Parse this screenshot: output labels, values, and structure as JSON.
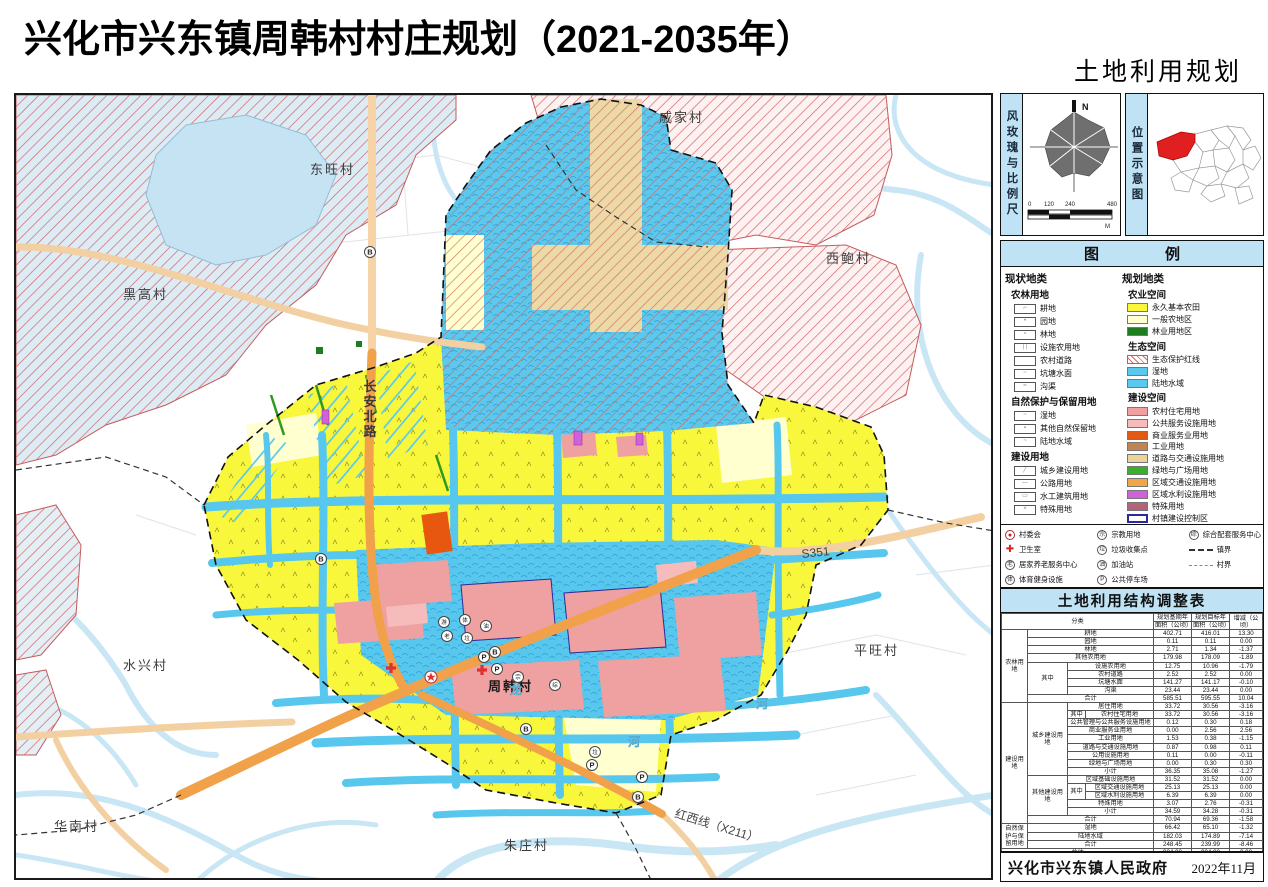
{
  "page": {
    "title": "兴化市兴东镇周韩村村庄规划（2021-2035年）",
    "map_title": "土地利用规划图"
  },
  "compass_panel": {
    "label": "风玫瑰与比例尺",
    "north_label": "N",
    "scale_ticks": [
      "0",
      "120",
      "240",
      "480"
    ],
    "scale_unit": "M"
  },
  "location_panel": {
    "label": "位置示意图"
  },
  "legend": {
    "title_left": "图",
    "title_right": "例",
    "current": {
      "title": "现状地类",
      "groups": [
        {
          "title": "农林用地",
          "items": [
            {
              "label": "耕地",
              "mark": "⌐"
            },
            {
              "label": "园地",
              "mark": "•"
            },
            {
              "label": "林地",
              "mark": "∘"
            },
            {
              "label": "设施农用地",
              "mark": "| |"
            },
            {
              "label": "农村道路",
              "mark": ""
            },
            {
              "label": "坑塘水面",
              "mark": "~"
            },
            {
              "label": "沟渠",
              "mark": "≈"
            }
          ]
        },
        {
          "title": "自然保护与保留用地",
          "items": [
            {
              "label": "湿地",
              "mark": "~"
            },
            {
              "label": "其他自然保留地",
              "mark": "▪"
            },
            {
              "label": "陆地水域",
              "mark": "~"
            }
          ]
        },
        {
          "title": "建设用地",
          "items": [
            {
              "label": "城乡建设用地",
              "mark": "╱"
            },
            {
              "label": "公路用地",
              "mark": "—"
            },
            {
              "label": "水工建筑用地",
              "mark": "▭"
            },
            {
              "label": "特殊用地",
              "mark": "×"
            }
          ]
        }
      ]
    },
    "planned": {
      "title": "规划地类",
      "groups": [
        {
          "title": "农业空间",
          "items": [
            {
              "label": "永久基本农田",
              "kind": "color",
              "color": "#f9f73b"
            },
            {
              "label": "一般农地区",
              "kind": "color",
              "color": "#ffffcf"
            },
            {
              "label": "林业用地区",
              "kind": "color",
              "color": "#1e7d1e"
            }
          ]
        },
        {
          "title": "生态空间",
          "items": [
            {
              "label": "生态保护红线",
              "kind": "hatch"
            },
            {
              "label": "湿地",
              "kind": "water"
            },
            {
              "label": "陆地水域",
              "kind": "water"
            }
          ]
        },
        {
          "title": "建设空间",
          "items": [
            {
              "label": "农村住宅用地",
              "kind": "color",
              "color": "#efa0a0"
            },
            {
              "label": "公共服务设施用地",
              "kind": "color",
              "color": "#f6bcbc"
            },
            {
              "label": "商业服务业用地",
              "kind": "color",
              "color": "#e25913"
            },
            {
              "label": "工业用地",
              "kind": "color",
              "color": "#c3854f"
            },
            {
              "label": "道路与交通设施用地",
              "kind": "color",
              "color": "#e8d49c"
            },
            {
              "label": "绿地与广场用地",
              "kind": "color",
              "color": "#39b02a"
            },
            {
              "label": "区域交通设施用地",
              "kind": "color",
              "color": "#f2a44a"
            },
            {
              "label": "区域水利设施用地",
              "kind": "color",
              "color": "#cf62d8"
            },
            {
              "label": "特殊用地",
              "kind": "color",
              "color": "#b2647a"
            },
            {
              "label": "村镇建设控制区",
              "kind": "outline-blue"
            }
          ]
        }
      ]
    },
    "points": {
      "col1": [
        {
          "sym": "●",
          "type": "circle-red",
          "label": "村委会"
        },
        {
          "sym": "✚",
          "type": "cross",
          "label": "卫生室"
        },
        {
          "sym": "老",
          "type": "circle",
          "label": "居家养老服务中心"
        },
        {
          "sym": "体",
          "type": "circle",
          "label": "体育健身设施"
        },
        {
          "sym": "游",
          "type": "circle",
          "label": "小游园/广场"
        }
      ],
      "col2": [
        {
          "sym": "宗",
          "type": "circle",
          "label": "宗教用地"
        },
        {
          "sym": "垃",
          "type": "circle",
          "label": "垃圾收集点"
        },
        {
          "sym": "油",
          "type": "circle",
          "label": "加油站"
        },
        {
          "sym": "P",
          "type": "circle",
          "label": "公共停车场"
        },
        {
          "sym": "B",
          "type": "circle",
          "label": "城乡公交停靠点"
        }
      ],
      "col3": [
        {
          "sym": "综",
          "type": "circle",
          "label": "综合配套服务中心"
        },
        {
          "sym": "",
          "type": "line-thick",
          "label": "镇界"
        },
        {
          "sym": "",
          "type": "line-thin",
          "label": "村界"
        }
      ]
    }
  },
  "table": {
    "title": "土地利用结构调整表",
    "header": {
      "classification": "分类",
      "base_year_line1": "规划基期年",
      "base_year_line2": "面积（公顷）",
      "target_year_line1": "规划目标年",
      "target_year_line2": "面积（公顷）",
      "change": "增减（公顷）"
    },
    "rows": [
      [
        {
          "t": "农林用地",
          "rs": 9
        },
        {
          "t": "耕地",
          "cs": 3
        },
        {
          "t": "402.71"
        },
        {
          "t": "416.01"
        },
        {
          "t": "13.30"
        }
      ],
      [
        {
          "t": "园地",
          "cs": 3
        },
        {
          "t": "0.11"
        },
        {
          "t": "0.11"
        },
        {
          "t": "0.00"
        }
      ],
      [
        {
          "t": "林地",
          "cs": 3
        },
        {
          "t": "2.71"
        },
        {
          "t": "1.34"
        },
        {
          "t": "-1.37"
        }
      ],
      [
        {
          "t": "其他农用地",
          "cs": 3
        },
        {
          "t": "179.98"
        },
        {
          "t": "178.09"
        },
        {
          "t": "-1.89"
        }
      ],
      [
        {
          "t": "其中",
          "rs": 4
        },
        {
          "t": "设施农用地",
          "cs": 2
        },
        {
          "t": "12.75"
        },
        {
          "t": "10.96"
        },
        {
          "t": "-1.79"
        }
      ],
      [
        {
          "t": "农村道路",
          "cs": 2
        },
        {
          "t": "2.52"
        },
        {
          "t": "2.52"
        },
        {
          "t": "0.00"
        }
      ],
      [
        {
          "t": "坑塘水面",
          "cs": 2
        },
        {
          "t": "141.27"
        },
        {
          "t": "141.17"
        },
        {
          "t": "-0.10"
        }
      ],
      [
        {
          "t": "沟渠",
          "cs": 2
        },
        {
          "t": "23.44"
        },
        {
          "t": "23.44"
        },
        {
          "t": "0.00"
        }
      ],
      [
        {
          "t": "合计",
          "cs": 3
        },
        {
          "t": "585.51"
        },
        {
          "t": "595.55"
        },
        {
          "t": "10.04"
        }
      ],
      [
        {
          "t": "建设用地",
          "rs": 15
        },
        {
          "t": "城乡建设用地",
          "rs": 9
        },
        {
          "t": "居住用地",
          "cs": 2
        },
        {
          "t": "33.72"
        },
        {
          "t": "30.56"
        },
        {
          "t": "-3.16"
        }
      ],
      [
        {
          "t": "其中"
        },
        {
          "t": "农村住宅用地"
        },
        {
          "t": "33.72"
        },
        {
          "t": "30.56"
        },
        {
          "t": "-3.16"
        }
      ],
      [
        {
          "t": "公共管理与公共服务设施用地",
          "cs": 2
        },
        {
          "t": "0.12"
        },
        {
          "t": "0.30"
        },
        {
          "t": "0.18"
        }
      ],
      [
        {
          "t": "商业服务业用地",
          "cs": 2
        },
        {
          "t": "0.00"
        },
        {
          "t": "2.56"
        },
        {
          "t": "2.56"
        }
      ],
      [
        {
          "t": "工业用地",
          "cs": 2
        },
        {
          "t": "1.53"
        },
        {
          "t": "0.38"
        },
        {
          "t": "-1.15"
        }
      ],
      [
        {
          "t": "道路与交通设施用地",
          "cs": 2
        },
        {
          "t": "0.87"
        },
        {
          "t": "0.98"
        },
        {
          "t": "0.11"
        }
      ],
      [
        {
          "t": "公用设施用地",
          "cs": 2
        },
        {
          "t": "0.11"
        },
        {
          "t": "0.00"
        },
        {
          "t": "-0.11"
        }
      ],
      [
        {
          "t": "绿地与广场用地",
          "cs": 2
        },
        {
          "t": "0.00"
        },
        {
          "t": "0.30"
        },
        {
          "t": "0.30"
        }
      ],
      [
        {
          "t": "小计",
          "cs": 2
        },
        {
          "t": "36.35"
        },
        {
          "t": "35.08"
        },
        {
          "t": "-1.27"
        }
      ],
      [
        {
          "t": "其他建设用地",
          "rs": 5
        },
        {
          "t": "区域基础设施用地",
          "cs": 2
        },
        {
          "t": "31.52"
        },
        {
          "t": "31.52"
        },
        {
          "t": "0.00"
        }
      ],
      [
        {
          "t": "其中",
          "rs": 2
        },
        {
          "t": "区域交通设施用地"
        },
        {
          "t": "25.13"
        },
        {
          "t": "25.13"
        },
        {
          "t": "0.00"
        }
      ],
      [
        {
          "t": "区域水利设施用地"
        },
        {
          "t": "6.39"
        },
        {
          "t": "6.39"
        },
        {
          "t": "0.00"
        }
      ],
      [
        {
          "t": "特殊用地",
          "cs": 2
        },
        {
          "t": "3.07"
        },
        {
          "t": "2.76"
        },
        {
          "t": "-0.31"
        }
      ],
      [
        {
          "t": "小计",
          "cs": 2
        },
        {
          "t": "34.59"
        },
        {
          "t": "34.28"
        },
        {
          "t": "-0.31"
        }
      ],
      [
        {
          "t": "合计",
          "cs": 3
        },
        {
          "t": "70.94"
        },
        {
          "t": "69.36"
        },
        {
          "t": "-1.58"
        }
      ],
      [
        {
          "t": "自然保护与保留用地",
          "rs": 3
        },
        {
          "t": "湿地",
          "cs": 3
        },
        {
          "t": "66.42"
        },
        {
          "t": "65.10"
        },
        {
          "t": "-1.32"
        }
      ],
      [
        {
          "t": "陆地水域",
          "cs": 3
        },
        {
          "t": "182.03"
        },
        {
          "t": "174.89"
        },
        {
          "t": "-7.14"
        }
      ],
      [
        {
          "t": "合计",
          "cs": 3
        },
        {
          "t": "248.45"
        },
        {
          "t": "239.99"
        },
        {
          "t": "-8.46"
        }
      ],
      [
        {
          "t": "总计",
          "cs": 4
        },
        {
          "t": "904.90"
        },
        {
          "t": "904.90"
        },
        {
          "t": "0.00"
        }
      ]
    ]
  },
  "footer": {
    "issuer": "兴化市兴东镇人民政府",
    "date": "2022年11月"
  },
  "map": {
    "villages": [
      {
        "name": "东旺村",
        "x": 294,
        "y": 79
      },
      {
        "name": "戚家村",
        "x": 643,
        "y": 27
      },
      {
        "name": "西鲍村",
        "x": 810,
        "y": 168
      },
      {
        "name": "黑高村",
        "x": 107,
        "y": 204
      },
      {
        "name": "水兴村",
        "x": 107,
        "y": 575
      },
      {
        "name": "华南村",
        "x": 38,
        "y": 736
      },
      {
        "name": "朱庄村",
        "x": 488,
        "y": 755
      },
      {
        "name": "平旺村",
        "x": 838,
        "y": 560
      },
      {
        "name": "周韩村",
        "x": 472,
        "y": 596,
        "main": true
      }
    ],
    "roads": [
      {
        "name": "长安北路",
        "x": 354,
        "y": 296,
        "vertical": true
      },
      {
        "name": "S351",
        "x": 786,
        "y": 463,
        "rot": -6
      },
      {
        "name": "红西线（X211）",
        "x": 658,
        "y": 722,
        "rot": 17
      }
    ],
    "waters": [
      {
        "name": "龙",
        "x": 494,
        "y": 599
      },
      {
        "name": "河",
        "x": 612,
        "y": 651
      },
      {
        "name": "河",
        "x": 740,
        "y": 613
      }
    ],
    "points": [
      {
        "sym": "B",
        "x": 354,
        "y": 157
      },
      {
        "sym": "B",
        "x": 305,
        "y": 464
      },
      {
        "sym": "B",
        "x": 479,
        "y": 557
      },
      {
        "sym": "B",
        "x": 510,
        "y": 634
      },
      {
        "sym": "B",
        "x": 622,
        "y": 702
      },
      {
        "sym": "P",
        "x": 468,
        "y": 562
      },
      {
        "sym": "P",
        "x": 481,
        "y": 574
      },
      {
        "sym": "P",
        "x": 626,
        "y": 682
      },
      {
        "sym": "P",
        "x": 576,
        "y": 670
      },
      {
        "sym": "游",
        "x": 428,
        "y": 527
      },
      {
        "sym": "体",
        "x": 449,
        "y": 525
      },
      {
        "sym": "老",
        "x": 431,
        "y": 541
      },
      {
        "sym": "垃",
        "x": 451,
        "y": 543
      },
      {
        "sym": "油",
        "x": 470,
        "y": 531
      },
      {
        "sym": "宗",
        "x": 502,
        "y": 582
      },
      {
        "sym": "综",
        "x": 539,
        "y": 590
      },
      {
        "sym": "垃",
        "x": 579,
        "y": 657
      }
    ],
    "committee": {
      "x": 415,
      "y": 582
    },
    "clinics": [
      {
        "x": 466,
        "y": 575
      },
      {
        "x": 375,
        "y": 573
      }
    ]
  }
}
